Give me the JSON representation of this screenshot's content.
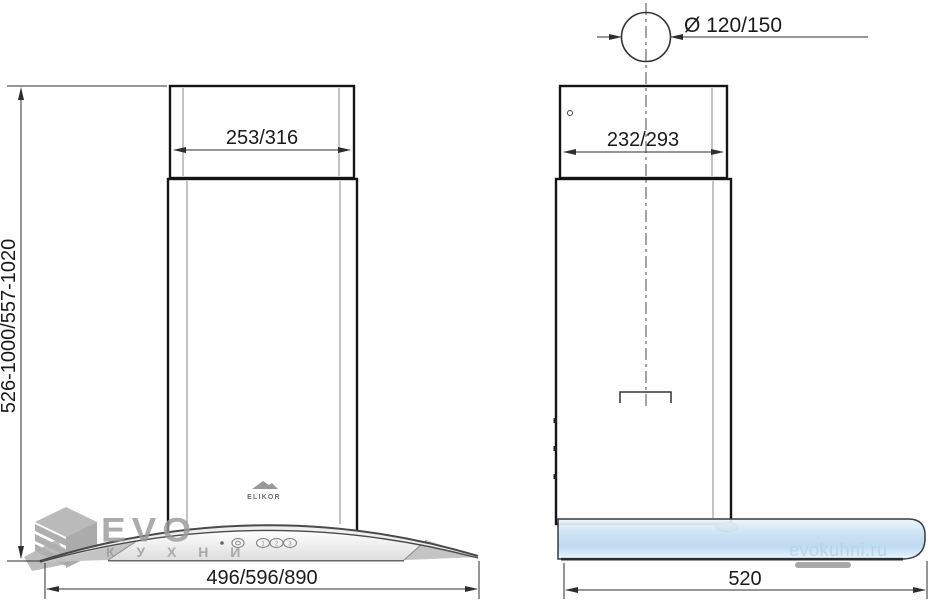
{
  "views": {
    "front": {
      "chimney_width": "253/316",
      "height_range": "526-1000/557-1020",
      "total_width": "496/596/890",
      "brand": "ELIKOR",
      "controls": {
        "speed_buttons": [
          "1",
          "2",
          "3"
        ]
      }
    },
    "side": {
      "chimney_depth": "232/293",
      "duct_diameter": "Ø 120/150",
      "total_depth": "520"
    }
  },
  "watermark": {
    "name": "EVO",
    "subtitle": "К У Х Н И",
    "site": "evokuhni.ru"
  },
  "colors": {
    "outline": "#141414",
    "dim_line": "#2e2e2e",
    "dim_text": "#1a1a1a",
    "inner_line": "#8a8a8a",
    "metal_dark": "#b2b2b2",
    "glass_blue": "#c3ddf1",
    "watermark_gray": "#9b9b9b",
    "watermark_blue": "#b3d3eb"
  }
}
